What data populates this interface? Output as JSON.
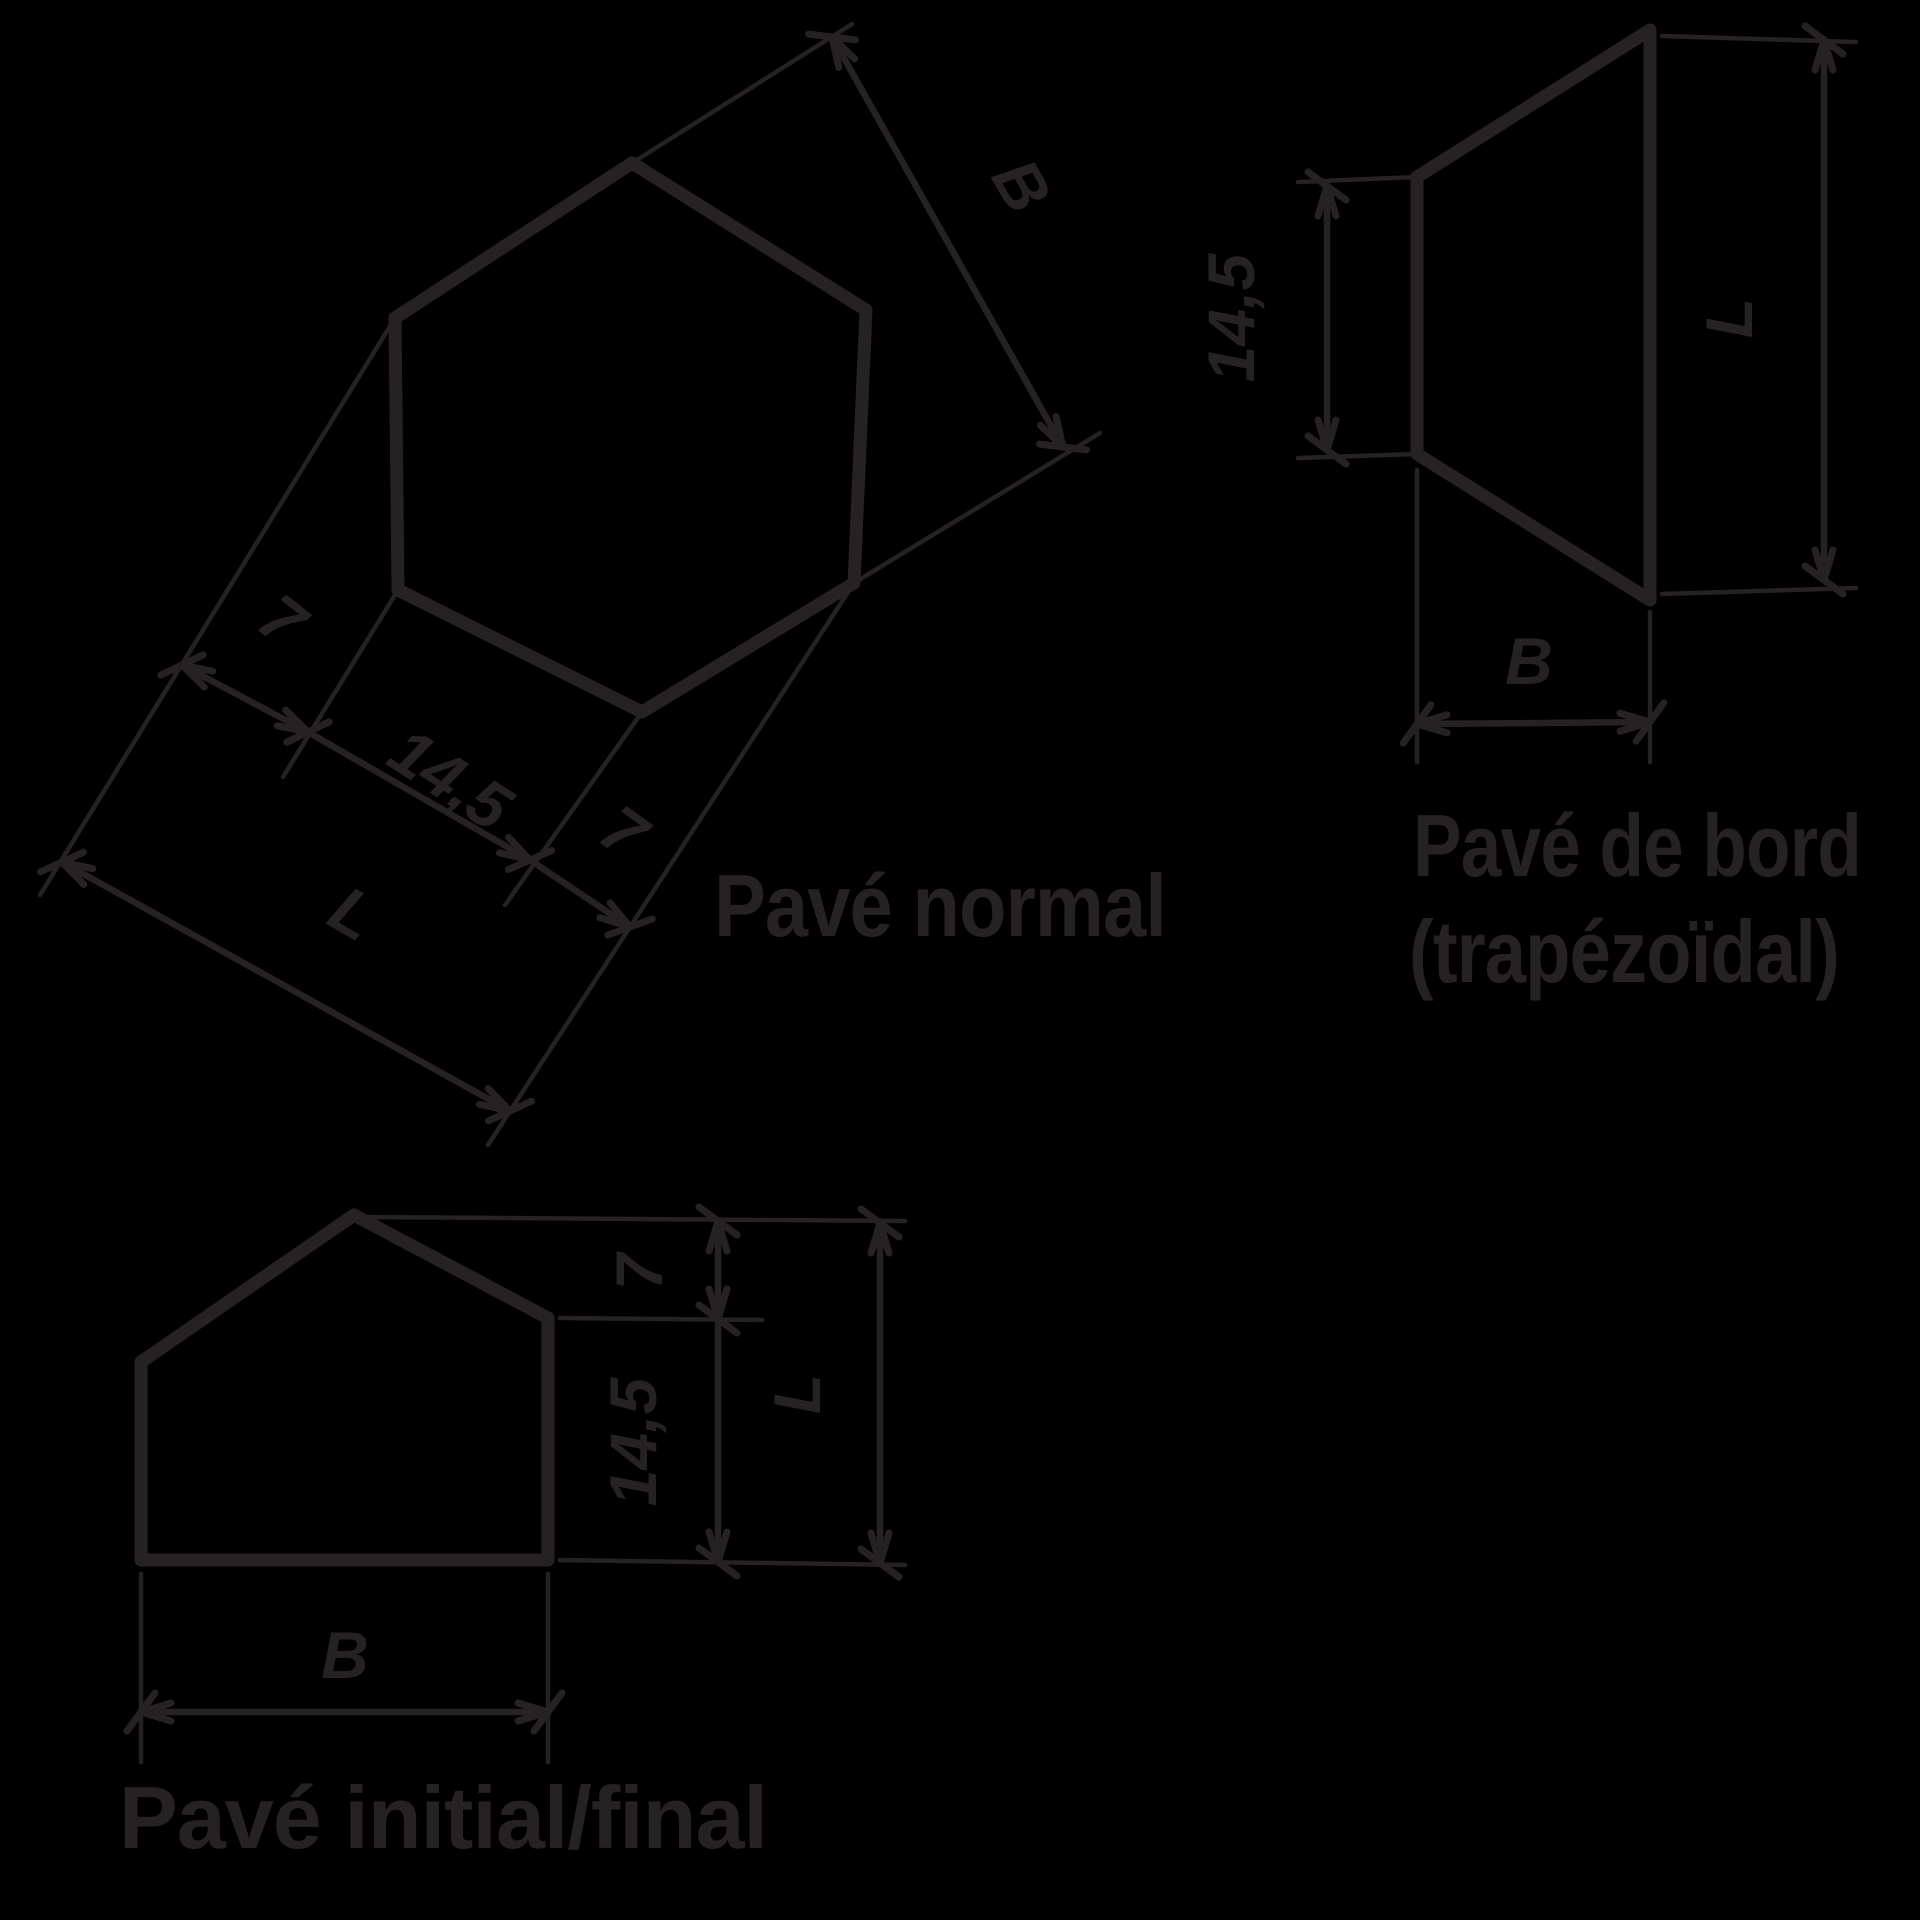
{
  "drawing_title": "Pavé hexagonal - formes des pavés",
  "colors": {
    "background": "#000000",
    "ink": "#262223"
  },
  "figures": [
    {
      "caption": "Pavé normal",
      "shape": "hexagon",
      "dims": {
        "width_across": "B",
        "seg1": "7",
        "seg2": "14,5",
        "seg3": "7",
        "overall": "L"
      }
    },
    {
      "caption": "Pavé de bord",
      "caption2": "(trapézoïdal)",
      "shape": "trapezoid",
      "dims": {
        "left_side": "14,5",
        "right_side": "L",
        "bottom": "B"
      }
    },
    {
      "caption": "Pavé initial/final",
      "shape": "pentagon",
      "dims": {
        "peak": "7",
        "side": "14,5",
        "overall": "L",
        "bottom": "B"
      }
    }
  ]
}
